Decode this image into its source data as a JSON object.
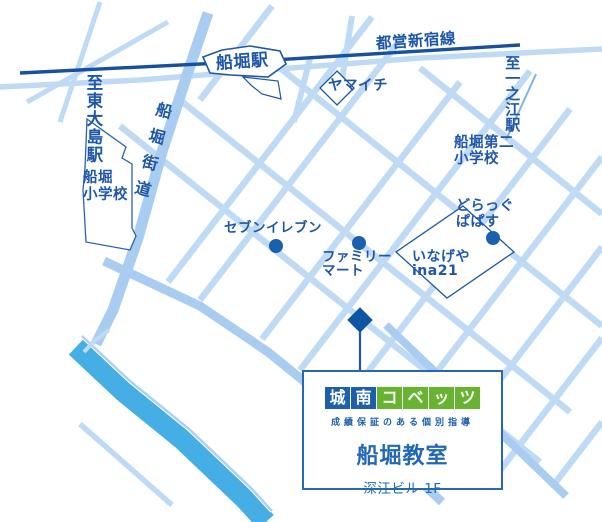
{
  "map": {
    "railway_label": "都営新宿線",
    "station_label": "船堀駅",
    "direction_left": "至東大島駅",
    "direction_right": "至一之江駅",
    "road_label": "船堀街道",
    "pois": {
      "yamaichi": "ヤマイチ",
      "seven_eleven": "セブンイレブン",
      "family_mart": [
        "ファミリー",
        "マート"
      ],
      "inageya": [
        "いなげや",
        "ina21"
      ],
      "drug_papas": [
        "どらっぐ",
        "ぱぱす"
      ],
      "funabori_elementary": [
        "船堀",
        "小学校"
      ],
      "funabori_daini_elementary": [
        "船堀第二",
        "小学校"
      ]
    },
    "colors": {
      "road": "#bfdaf4",
      "main_road": "#a9cdf0",
      "railway": "#17509f",
      "river": "#45aee4",
      "label_text": "#1e57a8",
      "poi_dot": "#1a61ad",
      "marker": "#0d56a4"
    }
  },
  "callout": {
    "logo_chars": [
      "城",
      "南",
      "コ",
      "ベ",
      "ッ",
      "ツ"
    ],
    "tagline": "成績保証のある個別指導",
    "classroom_name": "船堀教室",
    "address": "深江ビル 1F",
    "colors": {
      "logo_blue": "#1c5fad",
      "logo_green": "#66b42f",
      "text_blue": "#2268b5"
    }
  }
}
